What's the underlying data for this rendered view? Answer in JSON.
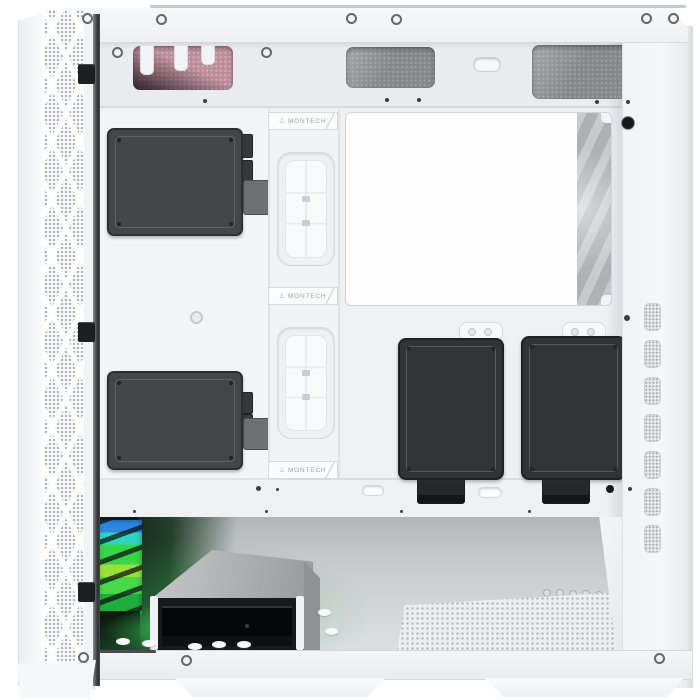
{
  "product": {
    "description": "White mid-tower PC case, side view with panel removed showing cable-management side, drives and PSU bay",
    "brand": "MONTECH"
  },
  "badges": [
    {
      "logo": "△",
      "text": "MONTECH"
    },
    {
      "logo": "△",
      "text": "MONTECH"
    },
    {
      "logo": "△",
      "text": "MONTECH"
    }
  ],
  "colors": {
    "background": "#ffffff",
    "case_white": "#f2f3f5",
    "panel_bright": "#fdfdfe",
    "drive_dark": "#454648",
    "drive_darker": "#2c2d2f",
    "ssd_black": "#323335",
    "mesh_gray": "#85878a",
    "mesh_pink": "#bd8d9b",
    "fan_gray": "#b7b9bb",
    "rgb_blue": "#2f86e0",
    "rgb_cyan": "#2fd3c0",
    "rgb_green": "#38d44a",
    "rgb_lime": "#9ae03a",
    "glow_green": "#2fae4f",
    "cage_silver": "#b5b7b9",
    "cage_black": "#17191b"
  }
}
